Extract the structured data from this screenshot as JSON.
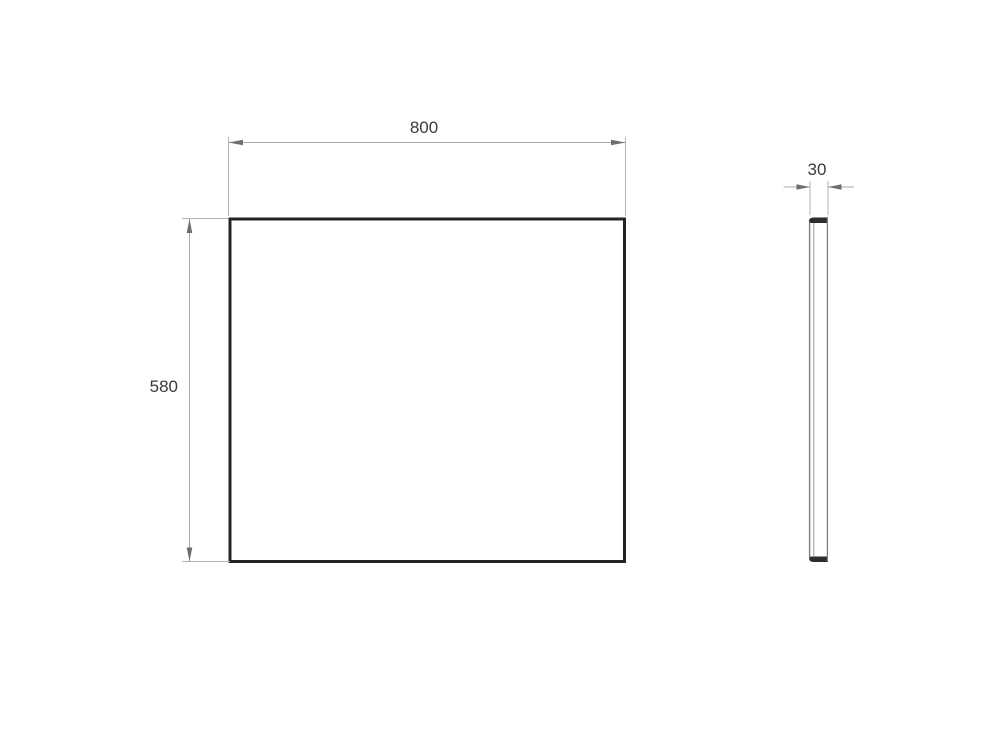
{
  "drawing": {
    "type": "technical-dimension-drawing",
    "views": {
      "front": {
        "name": "front view"
      },
      "side": {
        "name": "side profile view"
      }
    },
    "dimensions": {
      "width": {
        "label": "800"
      },
      "height": {
        "label": "580"
      },
      "depth": {
        "label": "30"
      }
    },
    "colors": {
      "background": "#ffffff",
      "object_line": "#242424",
      "side_edge": "#7d7d7d",
      "side_edge_light": "#9c9c9c",
      "cap_fill": "#2e2e2e",
      "dimension_line": "#a9a9a9",
      "extension_line": "#b4b4b4",
      "arrow": "#6e6e6e",
      "text": "#3a3a3a"
    }
  }
}
